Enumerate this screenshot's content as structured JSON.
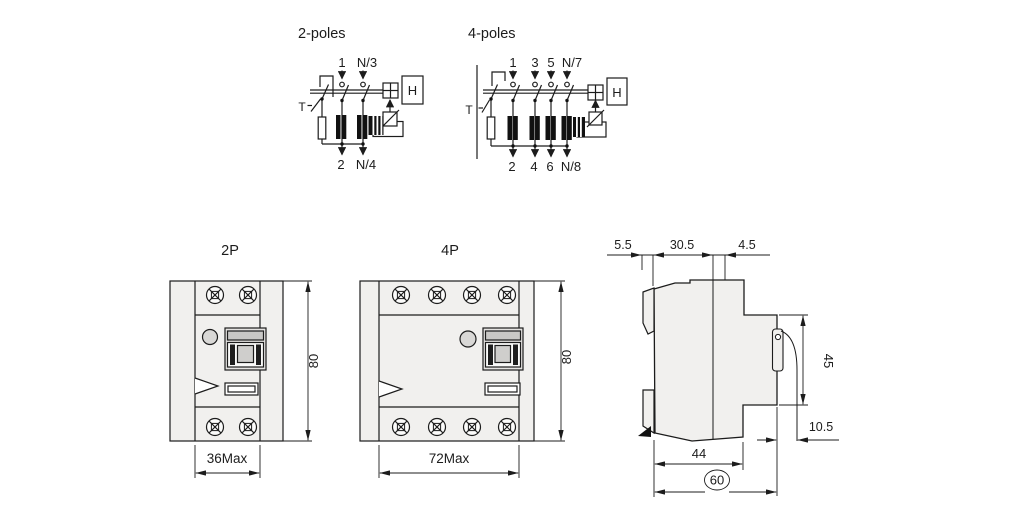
{
  "schematic_2p": {
    "title": "2-poles",
    "top_labels": [
      "1",
      "N/3"
    ],
    "bottom_labels": [
      "2",
      "N/4"
    ],
    "test_label": "T",
    "relay_label": "H"
  },
  "schematic_4p": {
    "title": "4-poles",
    "top_labels": [
      "1",
      "3",
      "5",
      "N/7"
    ],
    "bottom_labels": [
      "2",
      "4",
      "6",
      "N/8"
    ],
    "test_label": "T",
    "relay_label": "H"
  },
  "front_2p": {
    "title": "2P",
    "width_dim": "36Max",
    "height_dim": "80"
  },
  "front_4p": {
    "title": "4P",
    "width_dim": "72Max",
    "height_dim": "80"
  },
  "side_view": {
    "dim_rear_gap": "5.5",
    "dim_body_top": "30.5",
    "dim_front_top": "4.5",
    "dim_front_height": "45",
    "dim_lever": "10.5",
    "dim_base_depth": "44",
    "dim_total_depth": "60"
  },
  "colors": {
    "line": "#1c1c1c",
    "body_fill": "#f1f0ee",
    "background": "#ffffff"
  }
}
